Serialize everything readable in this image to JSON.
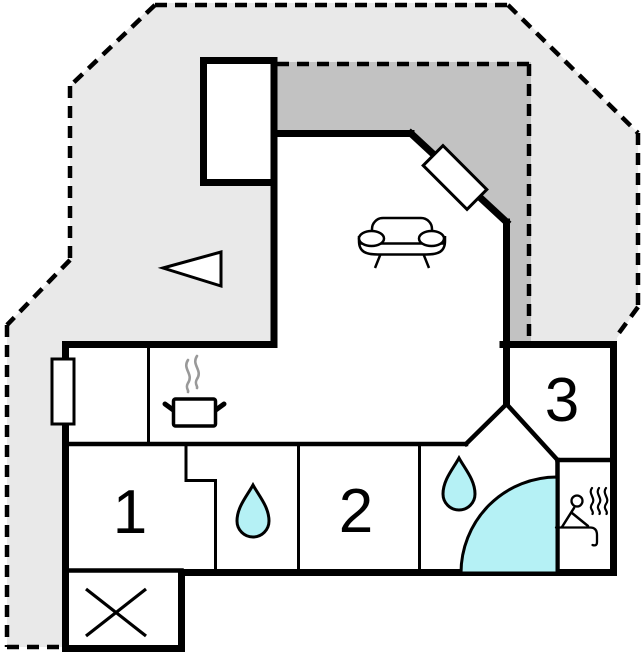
{
  "floor_plan": {
    "rooms": [
      {
        "name": "bedroom-1",
        "label": "1"
      },
      {
        "name": "bedroom-2",
        "label": "2"
      },
      {
        "name": "room-3",
        "label": "3"
      }
    ],
    "symbols": {
      "kitchen": "cooking-pot-with-steam",
      "living_room": "sofa",
      "bath_1": "water-drop",
      "bath_2": "water-drop-and-quarter-circle-shower",
      "sauna": "sitting-person-with-steam",
      "utility": "crossed-box",
      "yard": "direction-triangle",
      "openings": [
        "window-left-wall",
        "door-diagonal-wall"
      ]
    },
    "colors": {
      "yard": "#e9e9e9",
      "terrace": "#c2c2c2",
      "wall": "#000000",
      "interior": "#ffffff",
      "water": "#b5f1f5",
      "steam": "#999999"
    }
  }
}
